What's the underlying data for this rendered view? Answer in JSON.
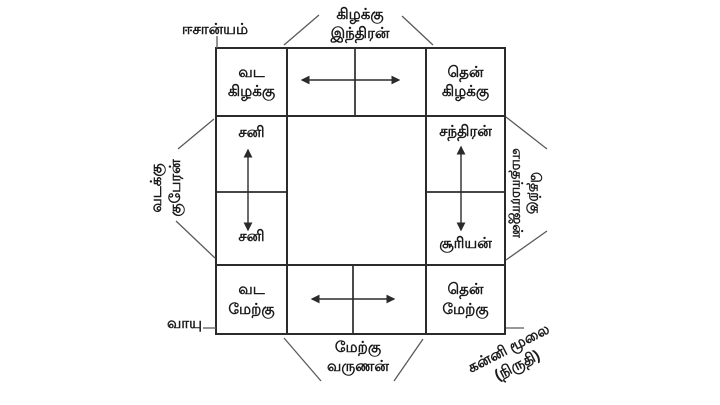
{
  "figure": {
    "colors": {
      "background": "#ffffff",
      "line": "#2b2b2b",
      "connector": "#5a5a5a",
      "text": "#1b1b1b"
    }
  },
  "outer_labels": {
    "northeast_corner": "ஈசான்யம்",
    "east_top": "கிழக்கு\nஇந்திரன்",
    "north_left": "வடக்கு\nகுபேரன்",
    "south_right": "தெற்கு\nஎமதர்மராஜன்",
    "northwest_corner": "வாயு",
    "west_bottom": "மேற்கு\nவருணன்",
    "southwest_corner": "கன்னி மூலை\n(நிருதி)"
  },
  "cells": {
    "north_east": "வட\nகிழக்கு",
    "south_east": "தென்\nகிழக்கு",
    "sani_upper": "சனி",
    "sani_lower": "சனி",
    "chandran": "சந்திரன்",
    "suryan": "சூரியன்",
    "north_west": "வட\nமேற்கு",
    "south_west": "தென்\nமேற்கு"
  }
}
